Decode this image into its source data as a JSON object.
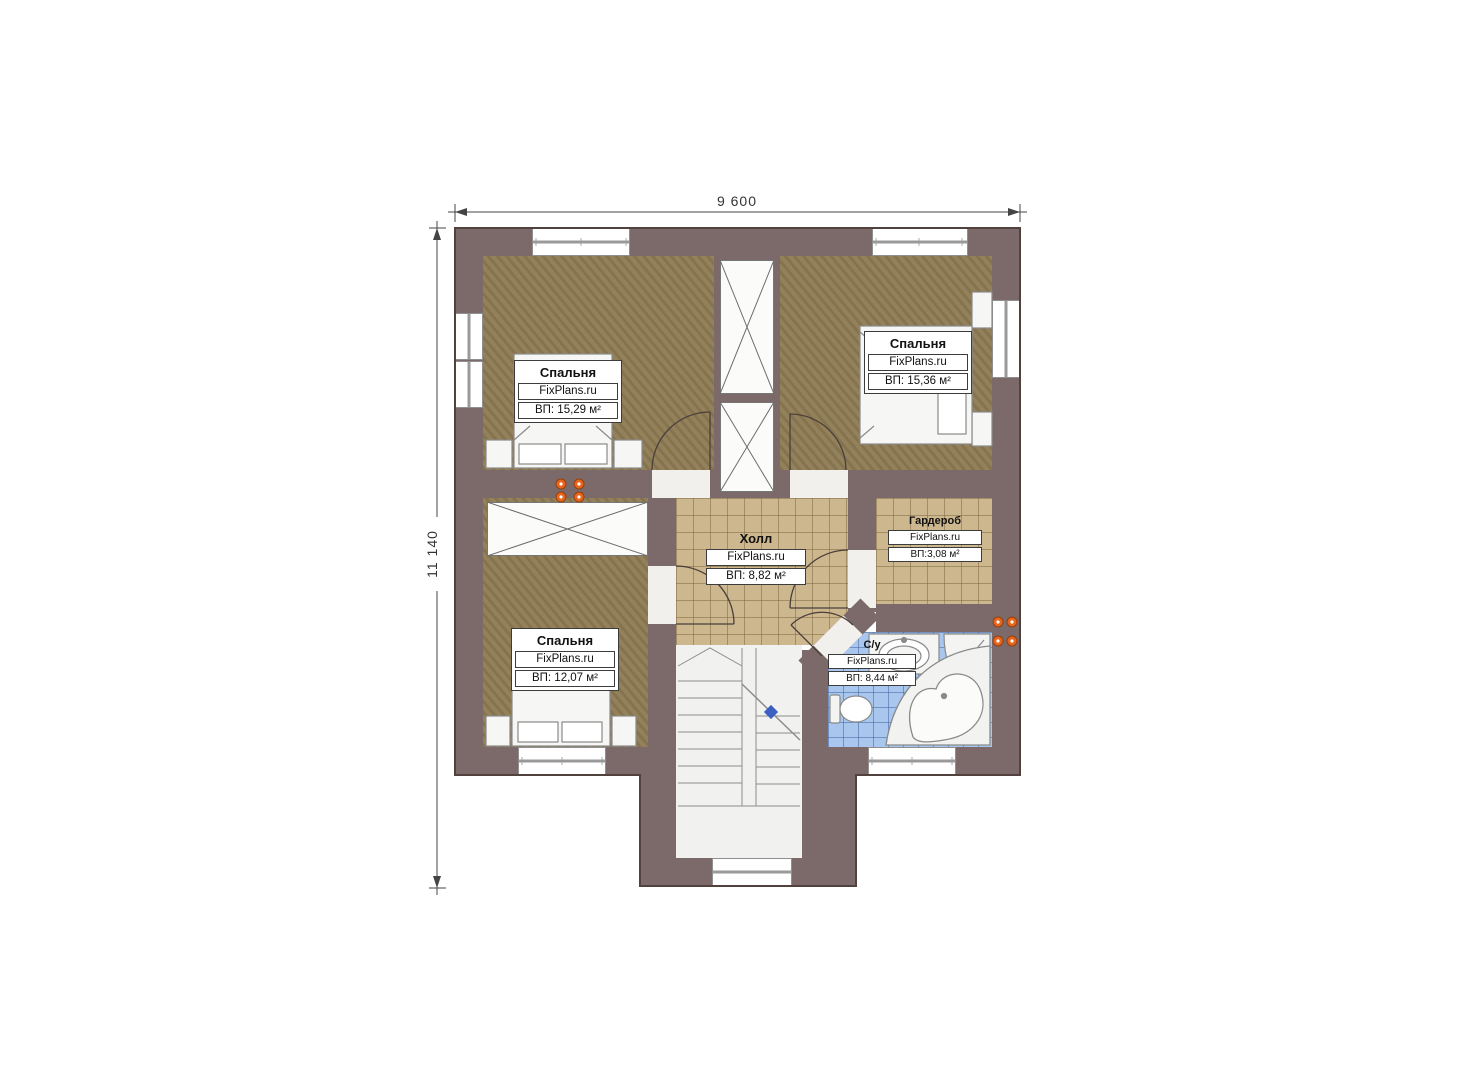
{
  "dimensions": {
    "width": "9 600",
    "height": "11 140"
  },
  "watermark": "FixPlans.ru",
  "rooms": [
    {
      "id": "bedroom-top-left",
      "name": "Спальня",
      "watermark": "FixPlans.ru",
      "area": "ВП: 15,29 м²"
    },
    {
      "id": "bedroom-top-right",
      "name": "Спальня",
      "watermark": "FixPlans.ru",
      "area": "ВП: 15,36 м²"
    },
    {
      "id": "hall",
      "name": "Холл",
      "watermark": "FixPlans.ru",
      "area": "ВП: 8,82 м²"
    },
    {
      "id": "wardrobe",
      "name": "Гардероб",
      "watermark": "FixPlans.ru",
      "area": "ВП:3,08 м²"
    },
    {
      "id": "bedroom-bottom-left",
      "name": "Спальня",
      "watermark": "FixPlans.ru",
      "area": "ВП: 12,07 м²"
    },
    {
      "id": "bathroom",
      "name": "С/у",
      "watermark": "FixPlans.ru",
      "area": "ВП: 8,44 м²"
    }
  ],
  "colors": {
    "wall": "#7b6a69",
    "bedroom_floor": "#8d7a53",
    "tile_floor": "#cdb78f",
    "bath_floor": "#a9c7ee",
    "radiator": "#e8651d",
    "stair_marker": "#3c5fc4",
    "dimension_line": "#444444",
    "label_border": "#3c3c3c"
  }
}
